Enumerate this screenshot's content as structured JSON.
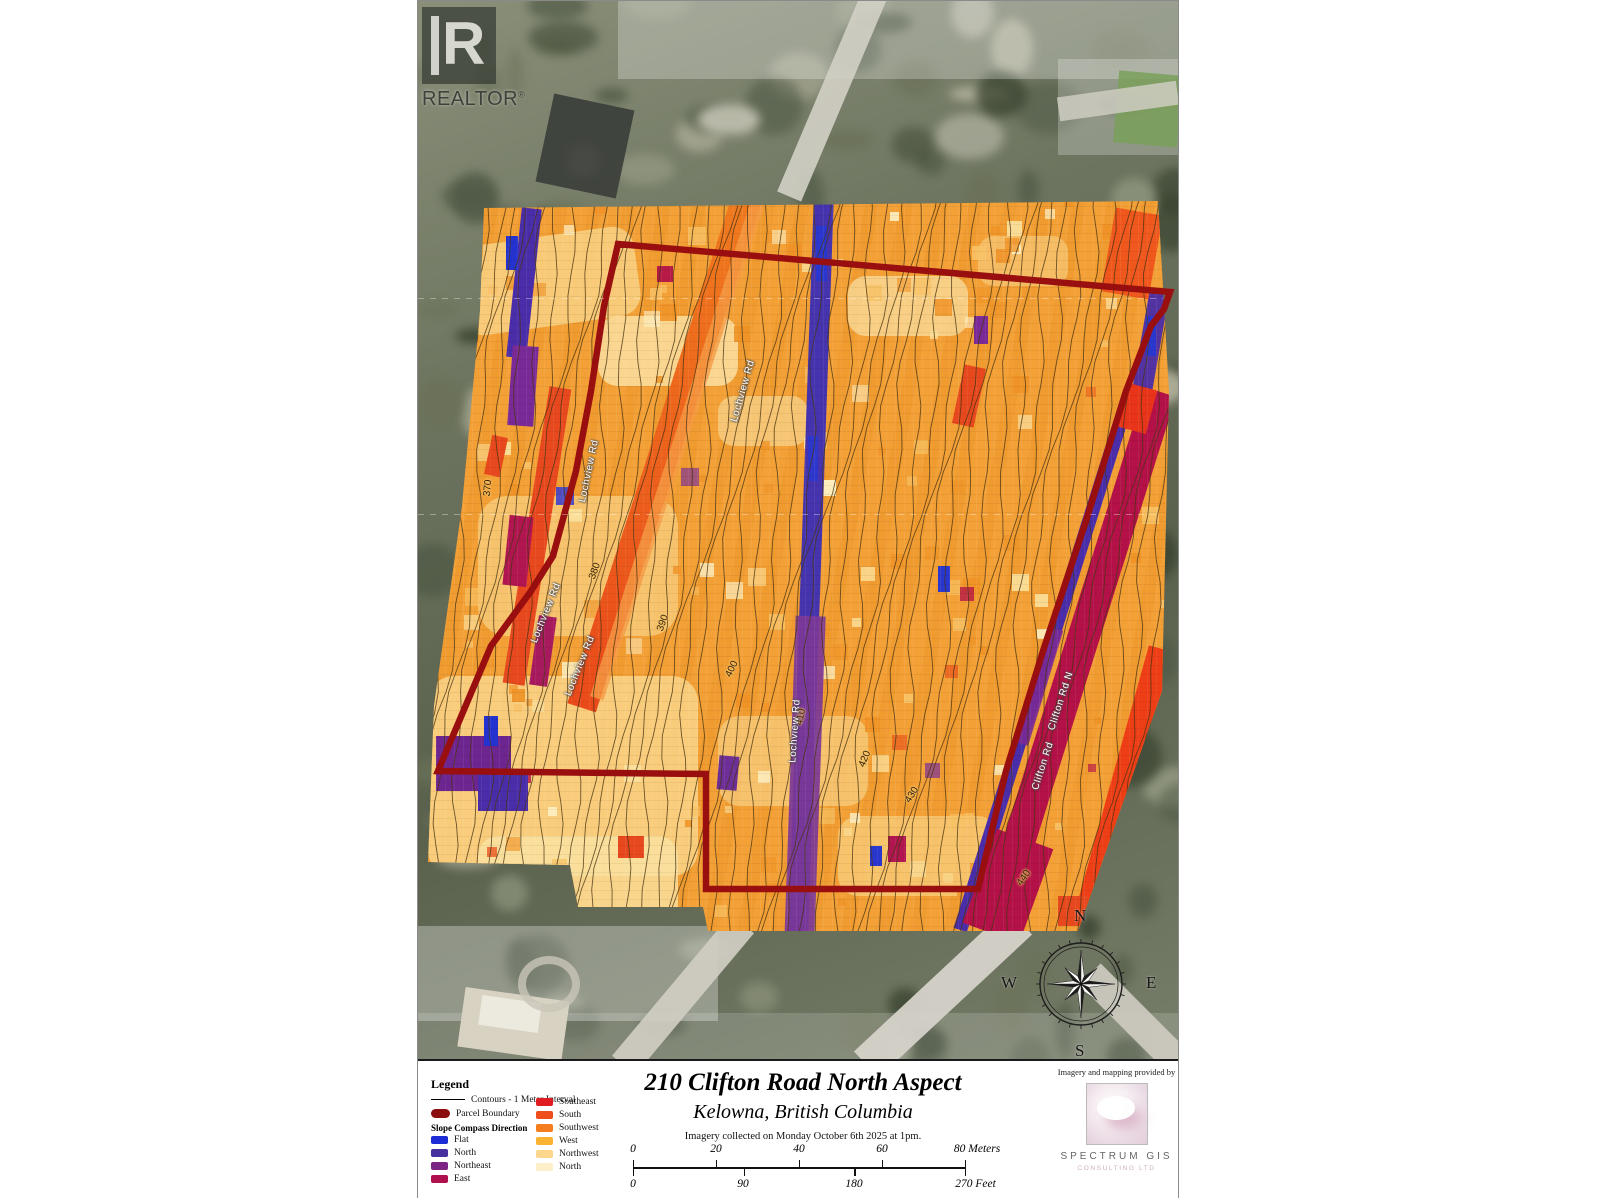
{
  "branding": {
    "logo_letter": "R",
    "realtor_text": "REALTOR",
    "registered": "®"
  },
  "map": {
    "road_labels": [
      {
        "text": "Lochview Rd"
      },
      {
        "text": "Lochview Rd"
      },
      {
        "text": "Lochview Rd"
      },
      {
        "text": "Lochview Rd"
      },
      {
        "text": "Lochview Rd"
      },
      {
        "text": "Clifton Rd"
      },
      {
        "text": "Clifton Rd N"
      }
    ],
    "contour_labels": [
      {
        "text": "370"
      },
      {
        "text": "380"
      },
      {
        "text": "390"
      },
      {
        "text": "400"
      },
      {
        "text": "410"
      },
      {
        "text": "420"
      },
      {
        "text": "430"
      },
      {
        "text": "440"
      }
    ],
    "compass": {
      "north": "N",
      "east": "E",
      "south": "S",
      "west": "W"
    }
  },
  "legend": {
    "title": "Legend",
    "contours_label": "Contours - 1 Meter Interval",
    "parcel_label": "Parcel Boundary",
    "parcel_color": "#8c0d0d",
    "section_title": "Slope Compass Direction",
    "col1": [
      {
        "label": "Flat",
        "color": "#1b2bd5"
      },
      {
        "label": "North",
        "color": "#46309f"
      },
      {
        "label": "Northeast",
        "color": "#7b2483"
      },
      {
        "label": "East",
        "color": "#b0104e"
      }
    ],
    "col2": [
      {
        "label": "Southeast",
        "color": "#e11b22"
      },
      {
        "label": "South",
        "color": "#ef4e1c"
      },
      {
        "label": "Southwest",
        "color": "#f47d1e"
      },
      {
        "label": "West",
        "color": "#f9b232"
      },
      {
        "label": "Northwest",
        "color": "#fbd68c"
      },
      {
        "label": "North",
        "color": "#fdf0c8"
      }
    ]
  },
  "title_block": {
    "title": "210 Clifton Road North Aspect",
    "subtitle": "Kelowna, British Columbia",
    "caption": "Imagery collected on Monday October 6th 2025 at 1pm.",
    "scale_meters": {
      "ticks": [
        "0",
        "20",
        "40",
        "60"
      ],
      "end": "80 Meters"
    },
    "scale_feet": {
      "ticks": [
        "0",
        "90",
        "180"
      ],
      "end": "270 Feet"
    }
  },
  "credits": {
    "heading": "Imagery and mapping provided by",
    "company": "SPECTRUM GIS",
    "subtext": "CONSULTING LTD"
  }
}
